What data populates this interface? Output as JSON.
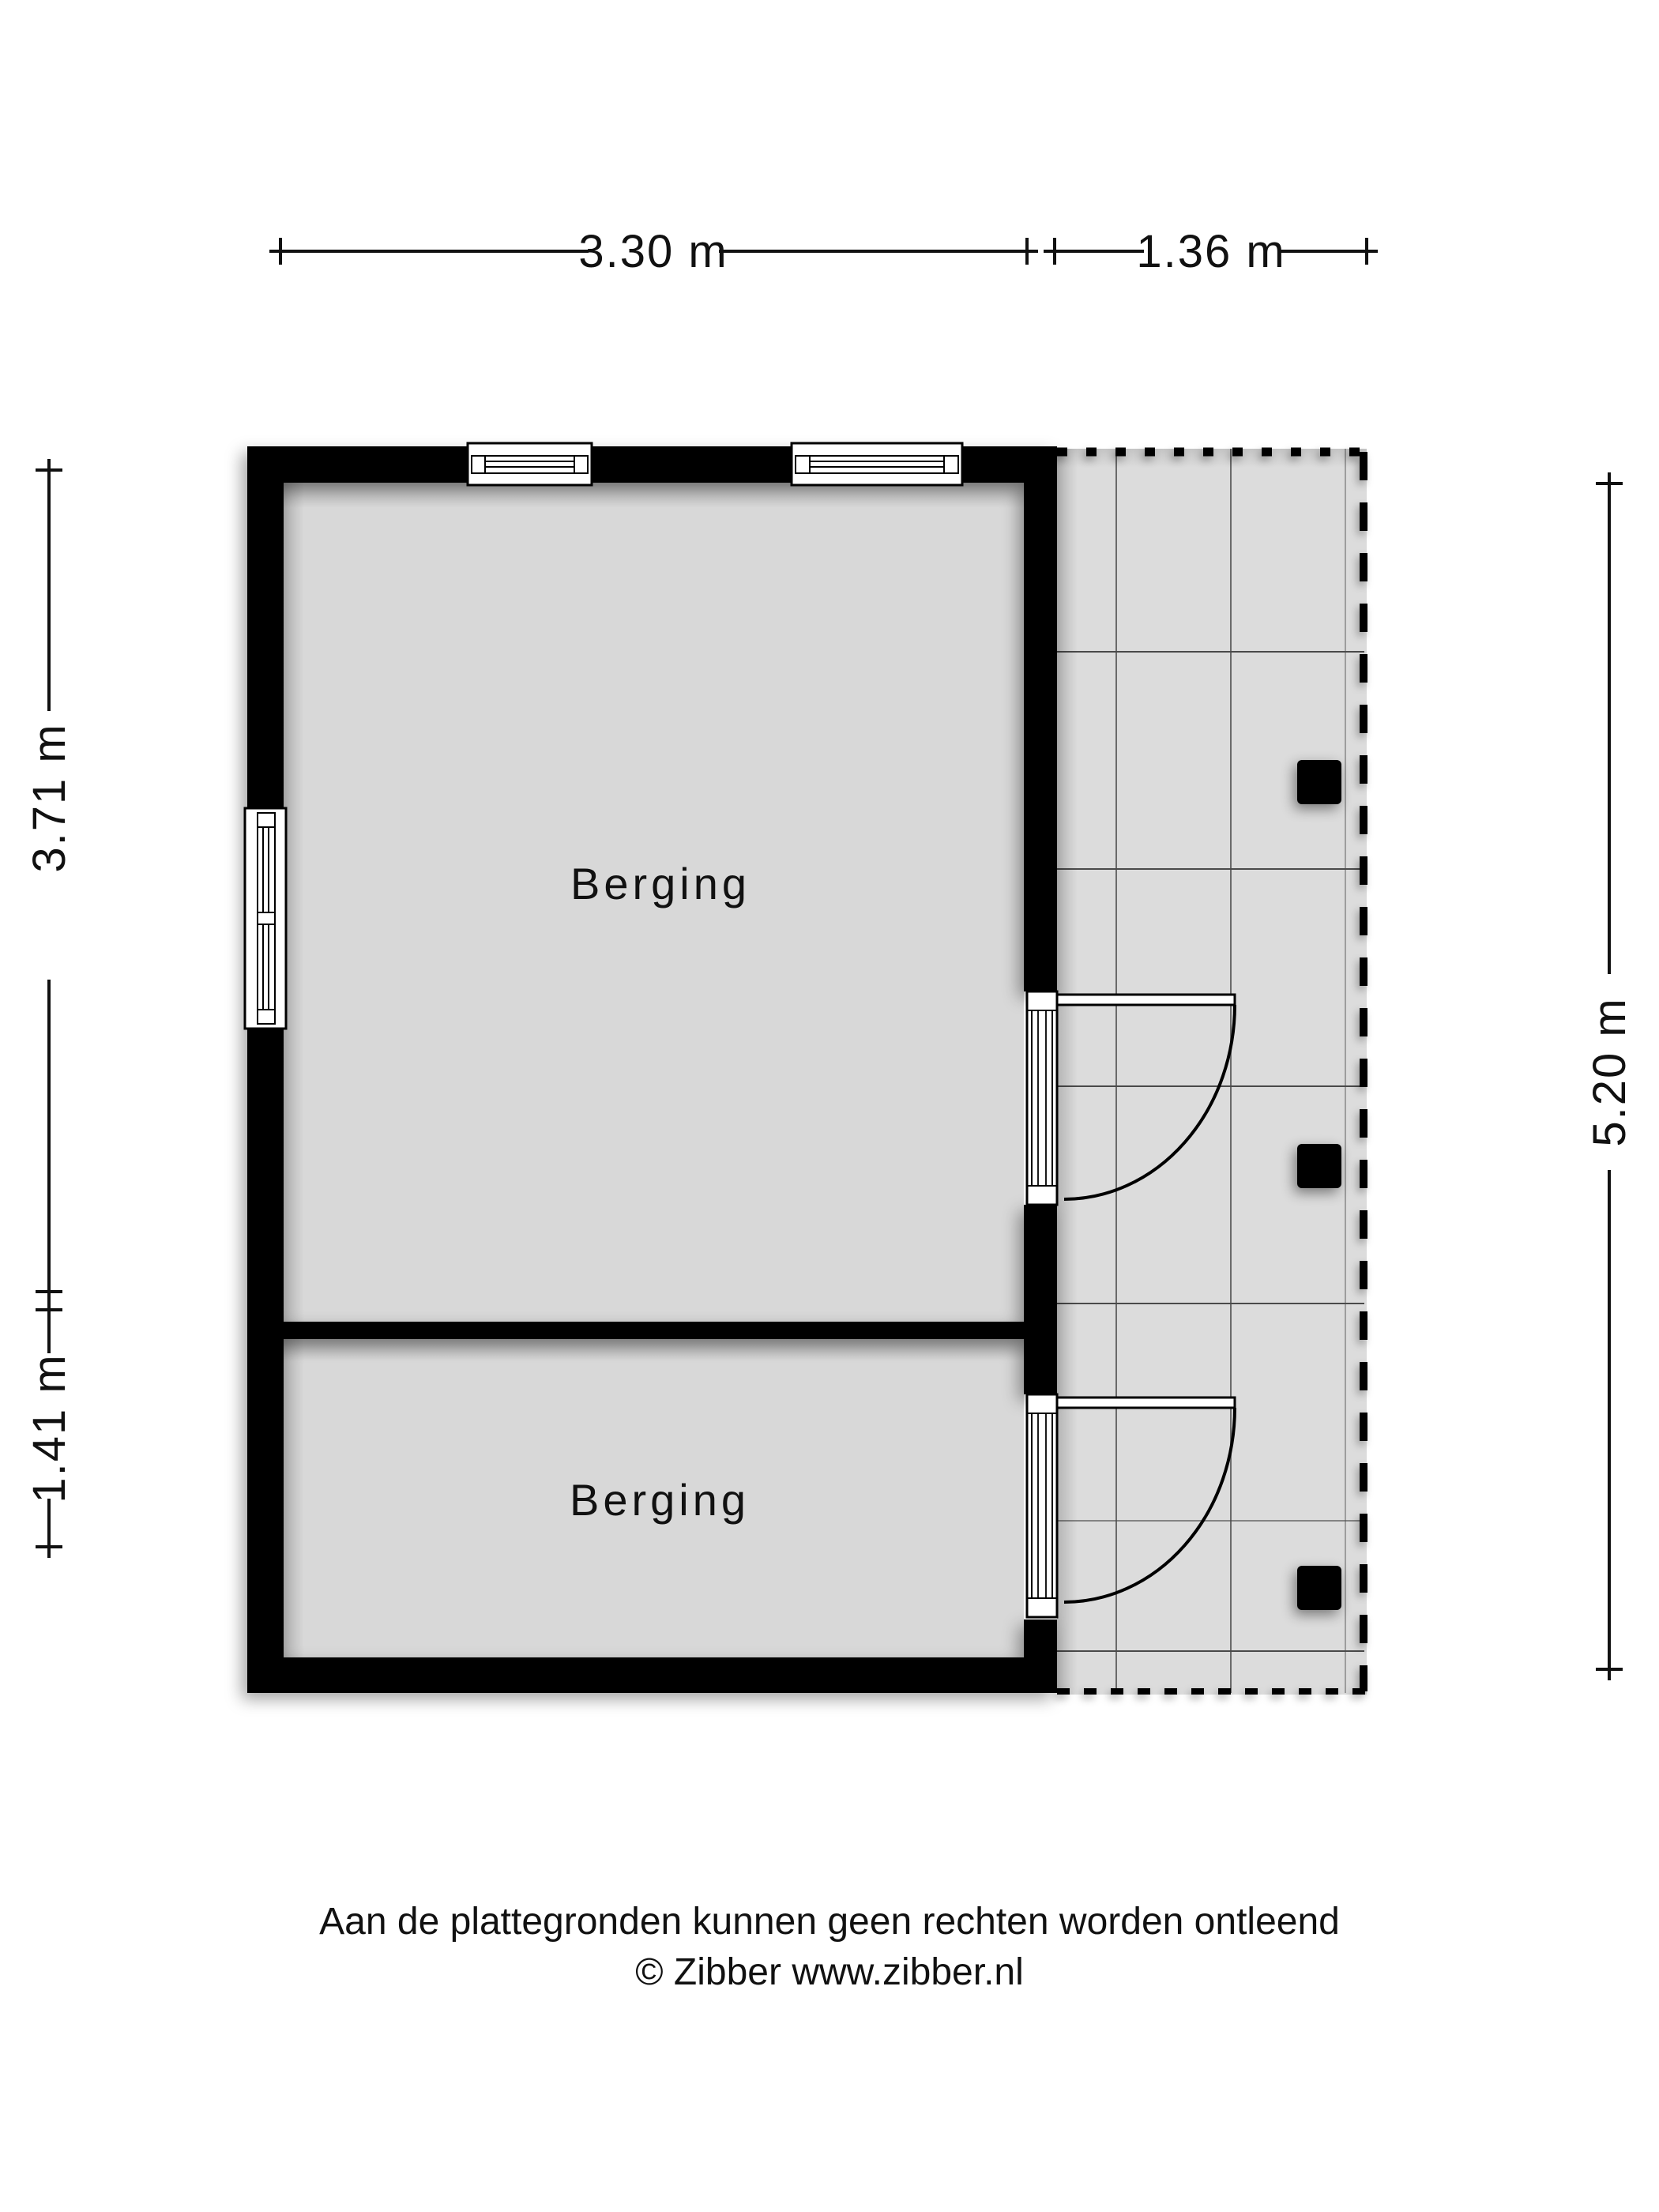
{
  "plan": {
    "rooms": [
      {
        "label": "Berging"
      },
      {
        "label": "Berging"
      }
    ]
  },
  "dimensions": {
    "top_width_main": "3.30 m",
    "top_width_terrace": "1.36 m",
    "left_height_upper": "3.71 m",
    "left_height_lower": "1.41 m",
    "right_height_total": "5.20 m"
  },
  "footer": {
    "disclaimer": "Aan de plattegronden kunnen geen rechten worden ontleend",
    "credit": "© Zibber www.zibber.nl"
  },
  "colors": {
    "wall": "#000000",
    "room_floor": "#d8d8d8",
    "terrace_floor": "#dcdcdc",
    "grid_line_h": "#4a4a4a",
    "grid_line_v": "#6a6a6a",
    "dimension_ink": "#111111",
    "background": "#ffffff"
  }
}
